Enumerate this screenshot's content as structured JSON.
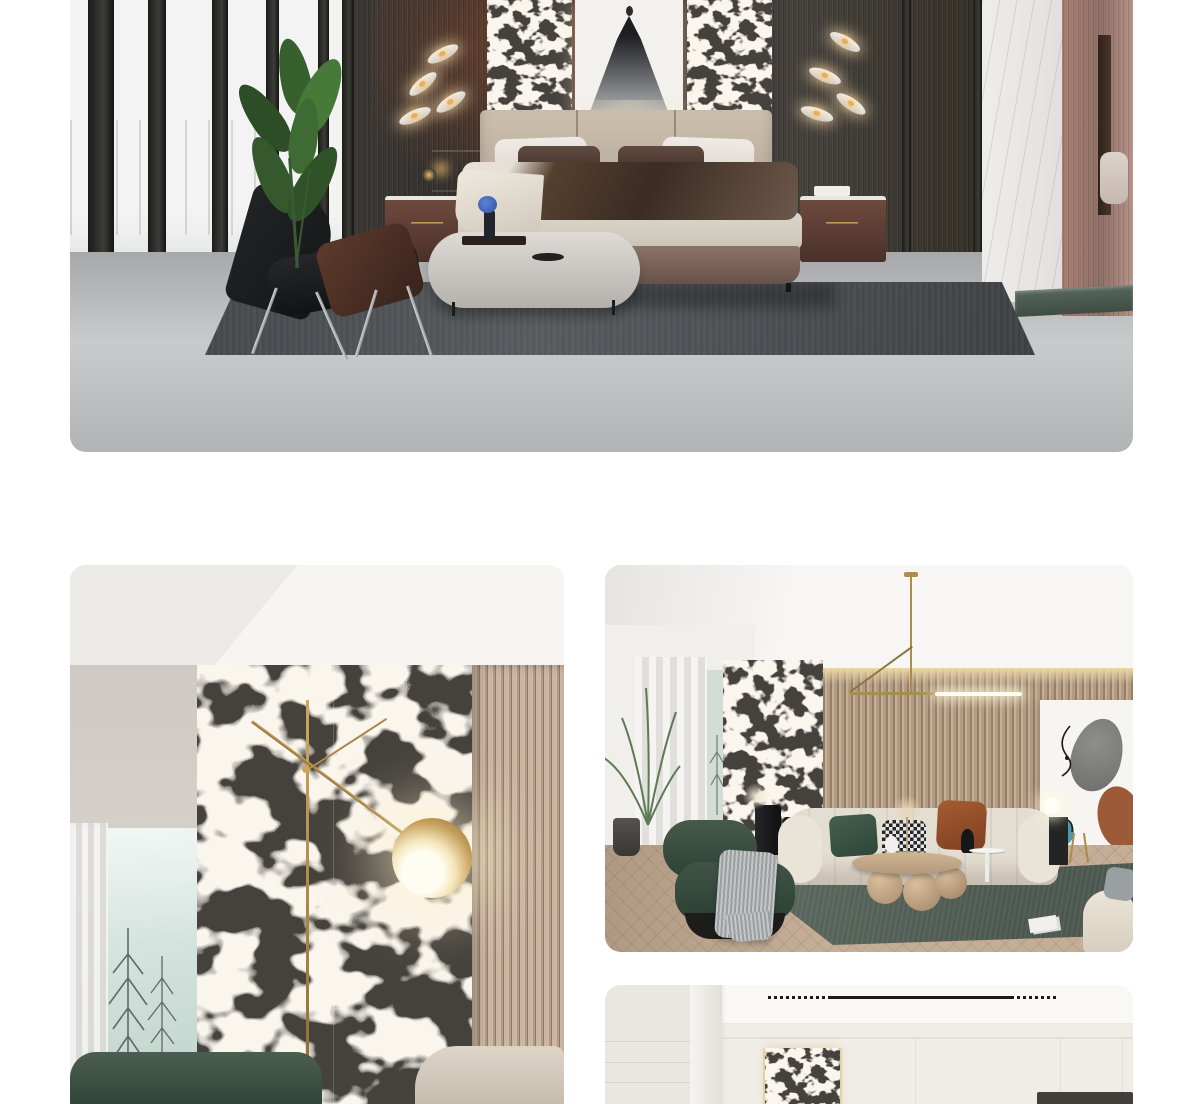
{
  "page": {
    "background": "#ffffff"
  },
  "gallery": {
    "images": [
      {
        "id": "bedroom-scene",
        "alt": "Modern bedroom with black and white marble headboard panels, ink dress art print, glass wardrobe wall, leather lounge chair, ottoman and grey rug"
      },
      {
        "id": "marble-wall-closeup",
        "alt": "Close-up of black and white marble feature wall with brass floor lamp, wood slat panel and foggy window"
      },
      {
        "id": "living-room-scene",
        "alt": "Living room with black and white marble panel, wood slat wall, brass pendant light, cream sofa, green armchair and round wooden coffee table"
      },
      {
        "id": "panelled-room-scene",
        "alt": "Cream panelled wall room with recessed linear ceiling vent and inset black and white marble slab"
      }
    ]
  },
  "palette": {
    "page_bg": "#ffffff",
    "marble_black": "#121212",
    "marble_white": "#efe9e2",
    "brass": "#b8934f",
    "wood_slat": "#b49c82",
    "rug_grey": "#4a4d50",
    "rug_green": "#5a665c",
    "sofa_cream": "#e3dcd0",
    "armchair_green": "#3a4f42",
    "floor_concrete": "#b2b3b5",
    "floor_wood": "#c2ac95",
    "wardrobe_brown": "#6a432f"
  }
}
